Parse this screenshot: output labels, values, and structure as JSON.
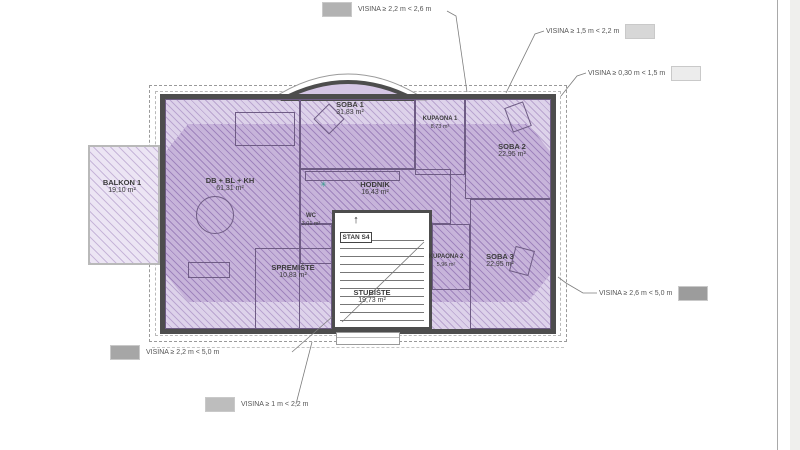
{
  "legend": [
    {
      "label": "VISINA ≥ 2,2 m < 2,6 m",
      "swatch": "#b2b2b2"
    },
    {
      "label": "VISINA ≥ 1,5 m < 2,2 m",
      "swatch": "#d7d7d7"
    },
    {
      "label": "VISINA ≥ 0,30 m < 1,5 m",
      "swatch": "#ececec"
    },
    {
      "label": "VISINA ≥ 2,6 m < 5,0 m",
      "swatch": "#9c9c9c"
    },
    {
      "label": "VISINA ≥ 2,2 m < 5,0 m",
      "swatch": "#a6a6a6"
    },
    {
      "label": "VISINA ≥ 1 m < 2,2 m",
      "swatch": "#bdbdbd"
    }
  ],
  "rooms": [
    {
      "name": "BALKON 1",
      "area": "19,10 m²"
    },
    {
      "name": "SOBA 1",
      "area": "31,83 m²"
    },
    {
      "name": "KUPAONA 1",
      "area": "8,73 m²"
    },
    {
      "name": "SOBA 2",
      "area": "22,95 m²"
    },
    {
      "name": "DB + BL + KH",
      "area": "61,31 m²"
    },
    {
      "name": "HODNIK",
      "area": "16,43 m²"
    },
    {
      "name": "WC",
      "area": "3,01 m²"
    },
    {
      "name": "SPREMIŠTE",
      "area": "10,83 m²"
    },
    {
      "name": "STUBIŠTE",
      "area": "19,73 m²"
    },
    {
      "name": "KUPAONA 2",
      "area": "5,96 m²"
    },
    {
      "name": "SOBA 3",
      "area": "22,95 m²"
    }
  ],
  "stairwell": {
    "unit_label": "STAN S4"
  },
  "icons": {
    "up_arrow": "↑",
    "center_marker": "✳"
  },
  "colors": {
    "plan_light": "#ddd2ea",
    "plan_dark": "#c7b4da",
    "hatch": "#8f6fb0",
    "wall": "#4d4d4d",
    "marker_green": "#2fa08c"
  }
}
